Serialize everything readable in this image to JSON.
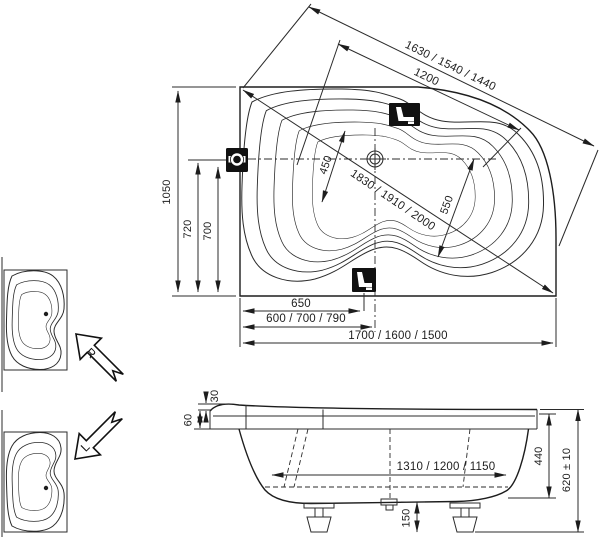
{
  "plan": {
    "overall_width": "1050",
    "tap_axis_offset": "720",
    "tap_hole_offset": "700",
    "seat_offset": "650",
    "drain_offset_options": "600 / 700 / 790",
    "length_options": "1700 / 1600 / 1500",
    "rim_diagonal_options": "1630 / 1540 / 1440",
    "inner_diagonal": "1200",
    "max_diagonal_options": "1830 / 1910 / 2000",
    "inner_width_head": "450",
    "inner_width_foot": "550"
  },
  "side": {
    "rim_rise": "30",
    "rim_thickness": "60",
    "bottom_length_options": "1310 / 1200 / 1150",
    "inner_depth": "440",
    "overall_height": "620 ± 10",
    "base_clearance": "150"
  },
  "variants": {
    "right_label": "R",
    "left_label": "L"
  },
  "colors": {
    "line": "#2b2b2b",
    "icon_fill": "#111111",
    "background": "#ffffff"
  }
}
